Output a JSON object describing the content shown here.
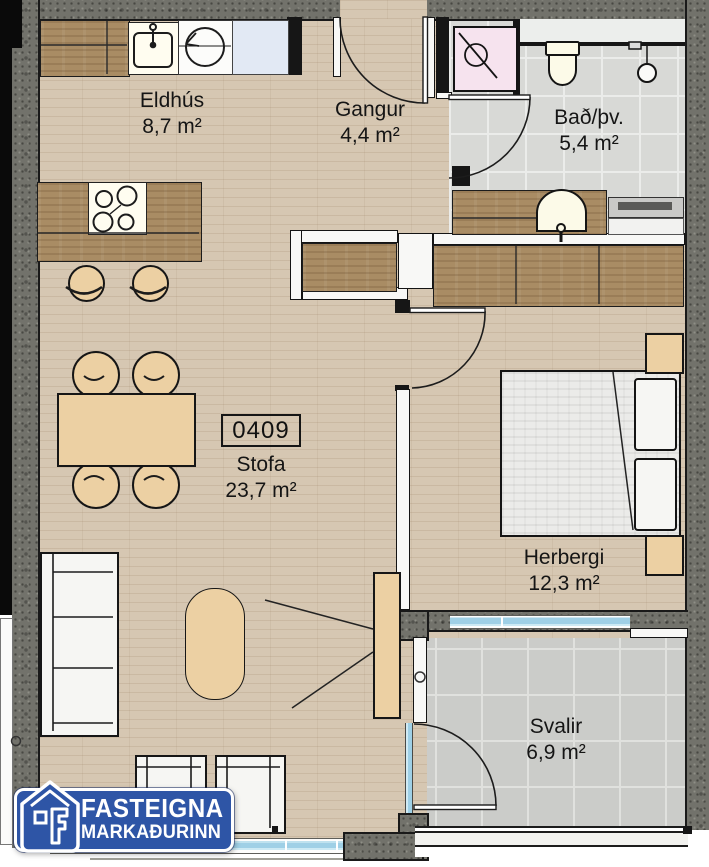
{
  "unit": {
    "number": "0409"
  },
  "rooms": {
    "kitchen": {
      "name": "Eldhús",
      "area": "8,7 m²"
    },
    "hallway": {
      "name": "Gangur",
      "area": "4,4 m²"
    },
    "bathroom": {
      "name": "Bað/þv.",
      "area": "5,4 m²"
    },
    "living": {
      "name": "Stofa",
      "area": "23,7 m²"
    },
    "bedroom": {
      "name": "Herbergi",
      "area": "12,3 m²"
    },
    "balcony": {
      "name": "Svalir",
      "area": "6,9 m²"
    }
  },
  "logo": {
    "line1": "FASTEIGNA",
    "line2": "MARKAÐURINN"
  },
  "colors": {
    "brand_blue": "#2e55a6",
    "wall_granite": "#72726b",
    "floor_wood": "#d6c7b2",
    "cabinet_wood": "#a98c64",
    "furniture_tan": "#ecd0a3",
    "tile_gray": "#d8d9d6",
    "glass_blue": "#9fd0e6",
    "shower_pink": "#f6e3ee"
  }
}
